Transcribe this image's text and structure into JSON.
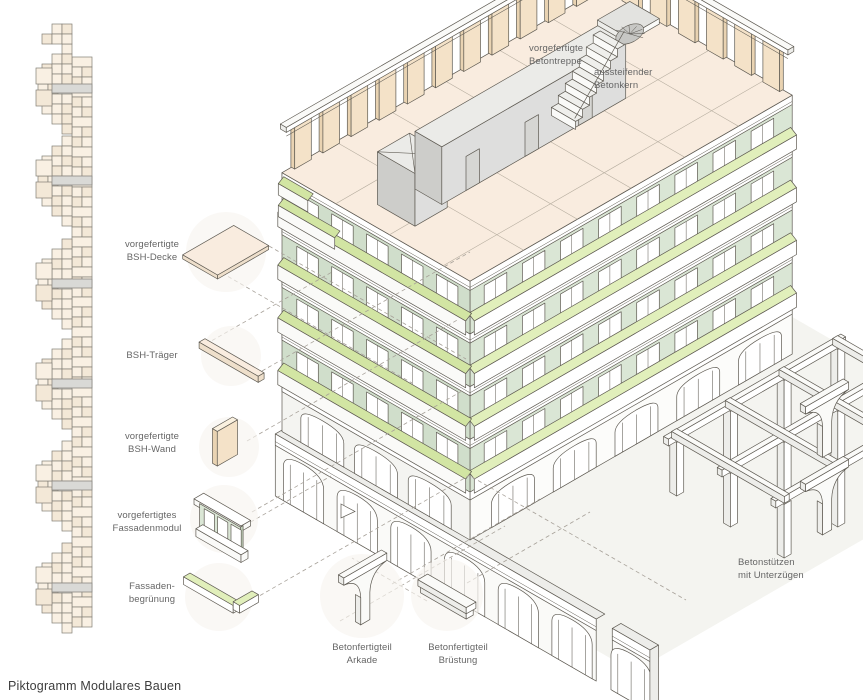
{
  "title": "Piktogramm Modulares Bauen",
  "diagram": {
    "type": "exploded-axonometric-architecture",
    "labels": {
      "betontreppe": [
        "vorgefertigte",
        "Betontreppe"
      ],
      "betonkern": [
        "aussteifender",
        "Betonkern"
      ],
      "bsh_decke": [
        "vorgefertigte",
        "BSH-Decke"
      ],
      "bsh_traeger": [
        "BSH-Träger"
      ],
      "bsh_wand": [
        "vorgefertigte",
        "BSH-Wand"
      ],
      "fassadenmodul": [
        "vorgefertigtes",
        "Fassadenmodul"
      ],
      "fassadenbegruenung": [
        "Fassaden-",
        "begrünung"
      ],
      "arkade": [
        "Betonfertigteil",
        "Arkade"
      ],
      "bruestung": [
        "Betonfertigteil",
        "Brüstung"
      ],
      "betonstuetzen": [
        "Betonstützen",
        "mit Unterzügen"
      ]
    },
    "palette": {
      "outline": "#5e5a52",
      "softline": "#b3aa9c",
      "dash": "#a7a199",
      "ground": "#f4f4f0",
      "white": "#ffffff",
      "offWhite": "#fafaf8",
      "cream": "#f9ecdf",
      "creamSide": "#eedfcb",
      "studBeige": "#f4e2c8",
      "studSide": "#e9d3b2",
      "studTop": "#faf1e0",
      "sage": "#dae6d5",
      "sageLeft": "#d0decb",
      "sageEnd": "#c4d4bd",
      "greenStrip": "#e1efbb",
      "greenStripSide": "#d2e5a3",
      "slabShade": "#ededea",
      "grayFace": "#dededd",
      "grayEnd": "#cdcdca",
      "grayTop": "#ebebe8",
      "grayDark": "#c7c7c4",
      "barGray": "#d9d9d6",
      "cellFill": "#f9f0e3",
      "cellFill2": "#f3e8d7",
      "halo": "#f7f4ef",
      "label": "#666666",
      "title": "#3e3e3e"
    }
  }
}
